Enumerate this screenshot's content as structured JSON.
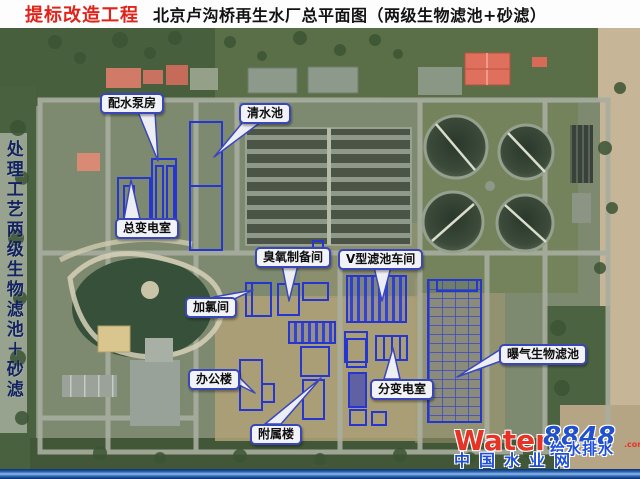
{
  "header": {
    "project_tag": "提标改造工程",
    "title": "北京卢沟桥再生水厂总平面图（两级生物滤池+砂滤）"
  },
  "sidebar": {
    "process_label": "处理工艺两级生物滤池＋砂滤"
  },
  "map": {
    "labels": [
      {
        "id": "water-distribution-pump-house",
        "text": "配水泵房"
      },
      {
        "id": "clear-water-tank",
        "text": "清水池"
      },
      {
        "id": "main-transformer-room",
        "text": "总变电室"
      },
      {
        "id": "ozone-preparation-room",
        "text": "臭氧制备间"
      },
      {
        "id": "v-type-filter-workshop",
        "text": "V型滤池车间"
      },
      {
        "id": "chlorination-room",
        "text": "加氯间"
      },
      {
        "id": "office-building",
        "text": "办公楼"
      },
      {
        "id": "auxiliary-building",
        "text": "附属楼"
      },
      {
        "id": "sub-transformer-room",
        "text": "分变电室"
      },
      {
        "id": "aerated-biological-filter",
        "text": "曝气生物滤池"
      }
    ]
  },
  "watermark": {
    "brand_en": "Water",
    "brand_num": "8848",
    "brand_suffix": ".com",
    "overlay_text": "给水排水",
    "site_name": "中国水业网"
  },
  "colors": {
    "title_red": "#e0241b",
    "title_black": "#121212",
    "callout_border_blue": "#3a47bb",
    "cad_overlay_blue": "#2636d0",
    "sidebar_text_navy": "#13235f",
    "watermark_red": "#e63325",
    "watermark_blue": "#2150cc",
    "bottom_bar_blue": "#2c66b5"
  }
}
